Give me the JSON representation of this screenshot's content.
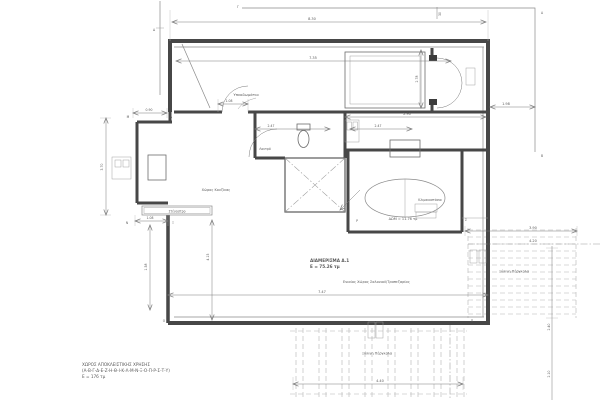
{
  "drawing": {
    "rooms": {
      "bedroom": "Υπνοδωμάτιο",
      "bathroom": "Λουτρό",
      "kitchen": "Χώρος Κουζίνας",
      "staircase": "Κλιμακοστάσιο",
      "living": "Ενιαίος Χώρος Σαλονιού/Τραπεζαρίας",
      "room_area": "ΔΩΜ = 11.76 τμ",
      "canopy": "Στέγαστρο",
      "pergola_right": "Ξύλινη Πέργκολα",
      "pergola_bottom": "Ξύλινη Πέργκολα"
    },
    "apartment": {
      "name": "ΔΙΑΜΕΡΙΣΜΑ Δ.1",
      "area": "Ε = 75.26 τμ"
    },
    "note": {
      "line1": "ΧΩΡΟΣ ΑΠΟΚΛΕΙΣΤΙΚΗΣ ΧΡΗΣΗΣ",
      "line2": "(Α-Β-Γ-Δ-Ε-Ζ-Η-Θ-Ι-Κ-Λ-Μ-Ν-Ξ-Ο-Π-Ρ-Σ-Τ-Υ)",
      "line3": "Ε = 176 τμ"
    },
    "dimensions": {
      "d830": "8.30",
      "d30": "30",
      "d735": "7.35",
      "d278": "2.78",
      "d290": "2.90",
      "d198": "1.98",
      "d108a": "1.08",
      "d090": "0.90",
      "d247a": "2.47",
      "d247b": "2.47",
      "d370": "3.70",
      "d158": "1.58",
      "d415": "4.15",
      "d747": "7.47",
      "d108b": "1.08",
      "d440": "4.40",
      "d390": "3.90",
      "d420": "4.20",
      "d240": "2.40",
      "d210": "2.10"
    },
    "letters": {
      "a": "Α",
      "b": "Β",
      "g": "Γ",
      "d": "Δ",
      "l": "Λ",
      "m": "Μ",
      "n": "Ν",
      "x": "Ξ",
      "o": "Ο",
      "p": "Π",
      "r": "Ρ",
      "s": "Σ"
    },
    "colors": {
      "wall": "#474747",
      "line": "#8a8a8a",
      "dimension": "#7a7a7a",
      "text": "#5a5a5a",
      "pergola_dash": "#b5b5b5",
      "background": "#ffffff"
    }
  }
}
